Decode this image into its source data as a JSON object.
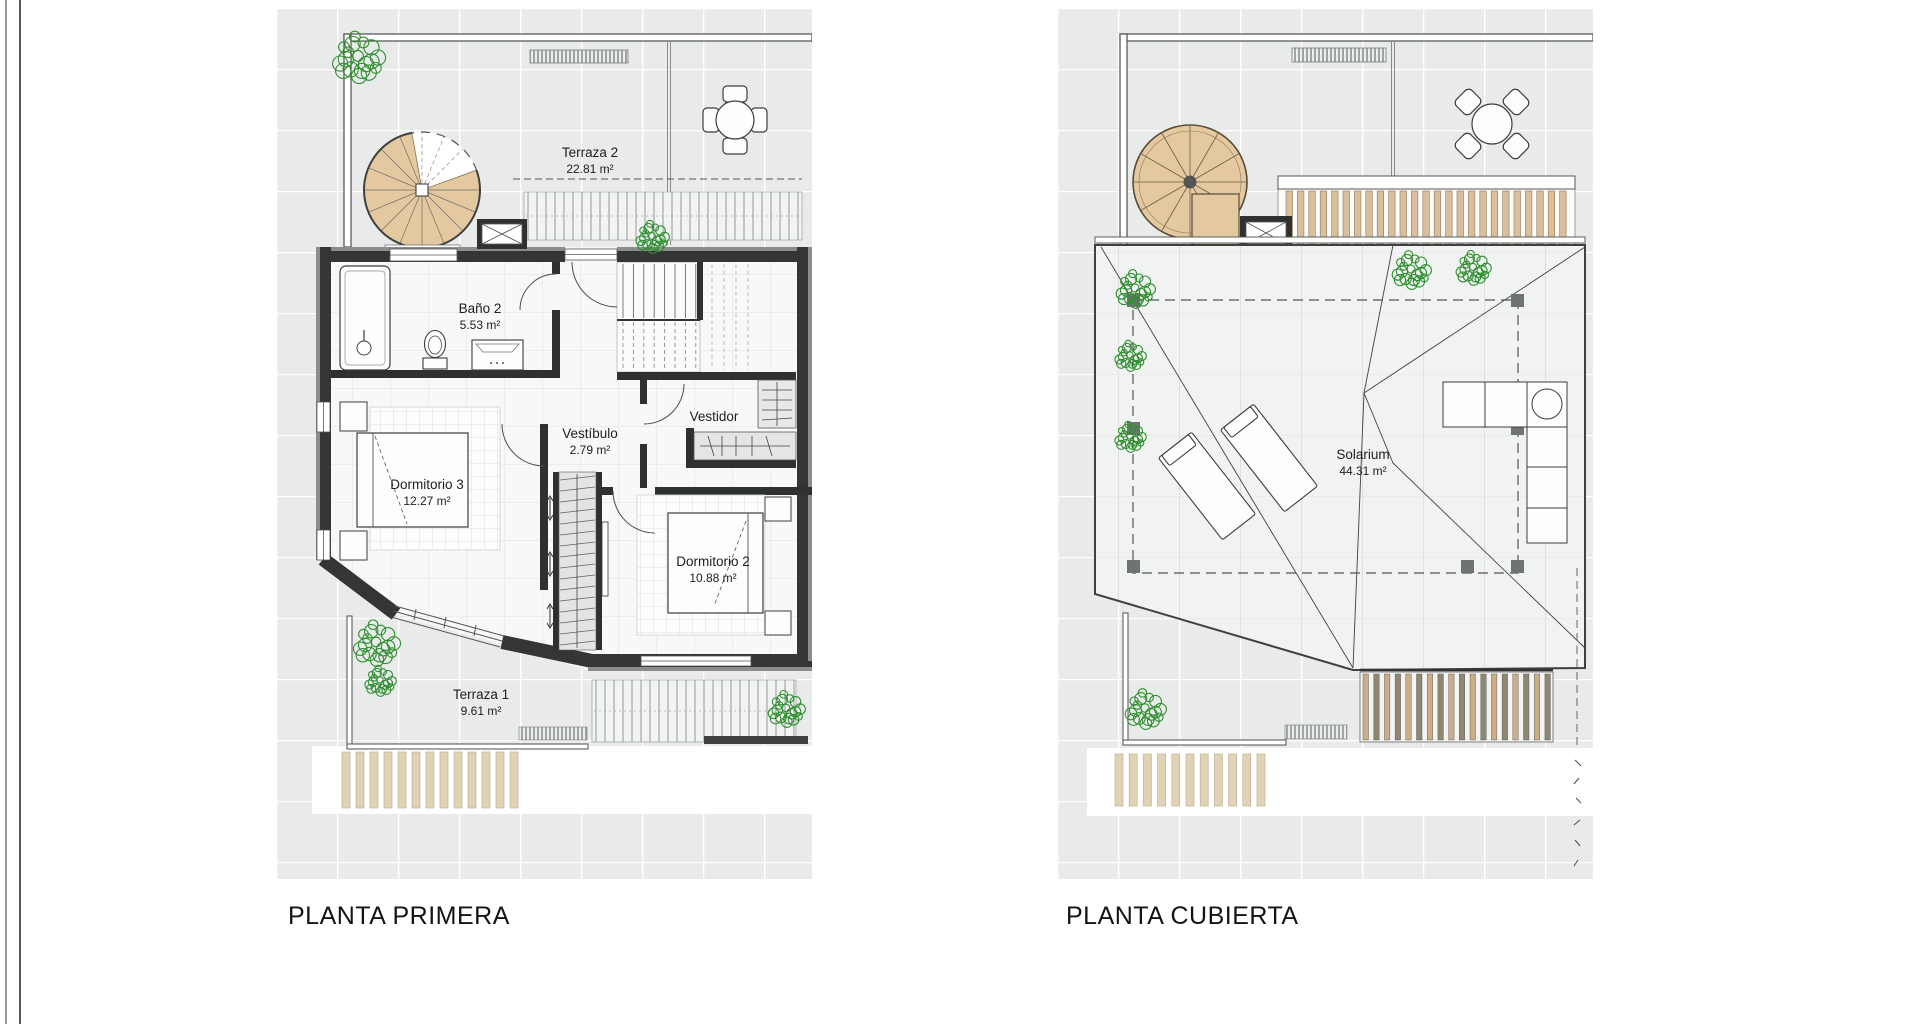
{
  "document": {
    "type": "architectural-floor-plans",
    "background": "#ffffff"
  },
  "colors": {
    "wall_dark": "#333536",
    "wall_mid": "#8a8d8c",
    "stair_tan": "#e4c89f",
    "pergola_strip_tan": "#e0d2b4",
    "slat_tan": "#d9bf9b",
    "louver_dark": "#8e8774",
    "plant_green": "#2f8f2f",
    "tile_fill": "#e9ebeb",
    "label_color": "#1d1d1d"
  },
  "plans": [
    {
      "id": "planta-primera",
      "title": "PLANTA PRIMERA",
      "rooms": [
        {
          "name": "Terraza 2",
          "area": "22.81 m²"
        },
        {
          "name": "Baño 2",
          "area": "5.53 m²"
        },
        {
          "name": "Vestíbulo",
          "area": "2.79 m²"
        },
        {
          "name": "Vestidor",
          "area": ""
        },
        {
          "name": "Dormitorio 3",
          "area": "12.27 m²"
        },
        {
          "name": "Dormitorio 2",
          "area": "10.88 m²"
        },
        {
          "name": "Terraza 1",
          "area": "9.61 m²"
        }
      ]
    },
    {
      "id": "planta-cubierta",
      "title": "PLANTA CUBIERTA",
      "rooms": [
        {
          "name": "Solarium",
          "area": "44.31 m²"
        }
      ]
    }
  ]
}
